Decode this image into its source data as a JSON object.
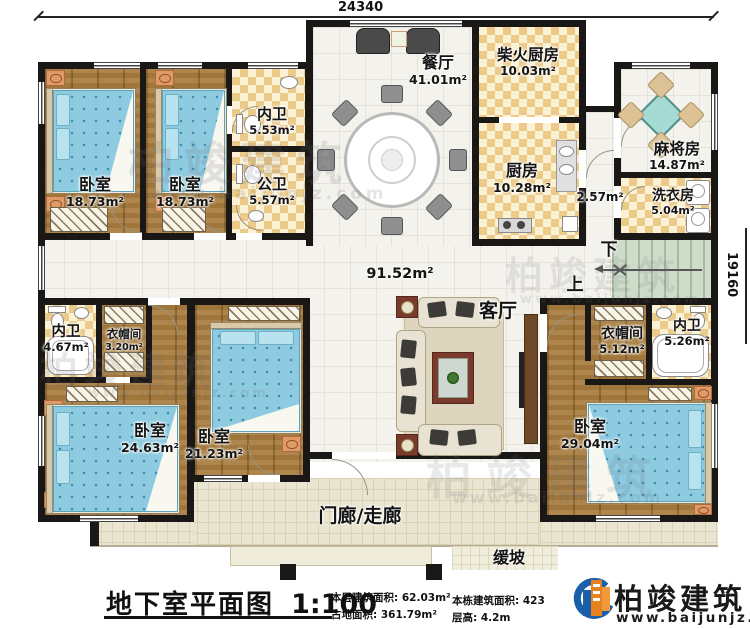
{
  "dimensions": {
    "top": "24340",
    "right": "19160"
  },
  "rooms": {
    "bedroom_tl1": {
      "name": "卧室",
      "area": "18.73m²"
    },
    "bedroom_tl2": {
      "name": "卧室",
      "area": "18.73m²"
    },
    "bath_top": {
      "name": "内卫",
      "area": "5.53m²"
    },
    "bath_public": {
      "name": "公卫",
      "area": "5.57m²"
    },
    "dining": {
      "name": "餐厅",
      "area": "41.01m²"
    },
    "wood_kitchen": {
      "name": "柴火厨房",
      "area": "10.03m²"
    },
    "kitchen": {
      "name": "厨房",
      "area": "10.28m²"
    },
    "mahjong": {
      "name": "麻将房",
      "area": "14.87m²"
    },
    "laundry": {
      "name": "洗衣房",
      "area": "5.04m²"
    },
    "corridor": {
      "area": "2.57m²"
    },
    "hall": {
      "area": "91.52m²"
    },
    "living": {
      "name": "客厅"
    },
    "bath_left": {
      "name": "内卫",
      "area": "4.67m²"
    },
    "cloak_left": {
      "name": "衣帽间",
      "area": "3.20m²"
    },
    "bedroom_bl1": {
      "name": "卧室",
      "area": "24.63m²"
    },
    "bedroom_bl2": {
      "name": "卧室",
      "area": "21.23m²"
    },
    "cloak_master": {
      "name": "衣帽间",
      "area": "5.12m²"
    },
    "bath_master": {
      "name": "内卫",
      "area": "5.26m²"
    },
    "bedroom_master": {
      "name": "卧室",
      "area": "29.04m²"
    },
    "porch": {
      "name": "门廊/走廊"
    },
    "ramp": {
      "name": "缓坡"
    }
  },
  "stairs": {
    "down": "下",
    "up": "上"
  },
  "footer": {
    "title": "地下室平面图",
    "scale": "1:100",
    "stats": [
      {
        "label": "本层建筑面积:",
        "value": "62.03m²"
      },
      {
        "label": "占地面积:",
        "value": "361.79m²"
      },
      {
        "label": "本栋建筑面积:",
        "value": "423"
      },
      {
        "label": "层高:",
        "value": "4.2m"
      }
    ]
  },
  "logo": {
    "name": "柏竣建筑",
    "website": "www.baijunjz.com"
  },
  "watermark": {
    "brand": "柏竣建筑",
    "site": "www.baijunjz.com"
  }
}
